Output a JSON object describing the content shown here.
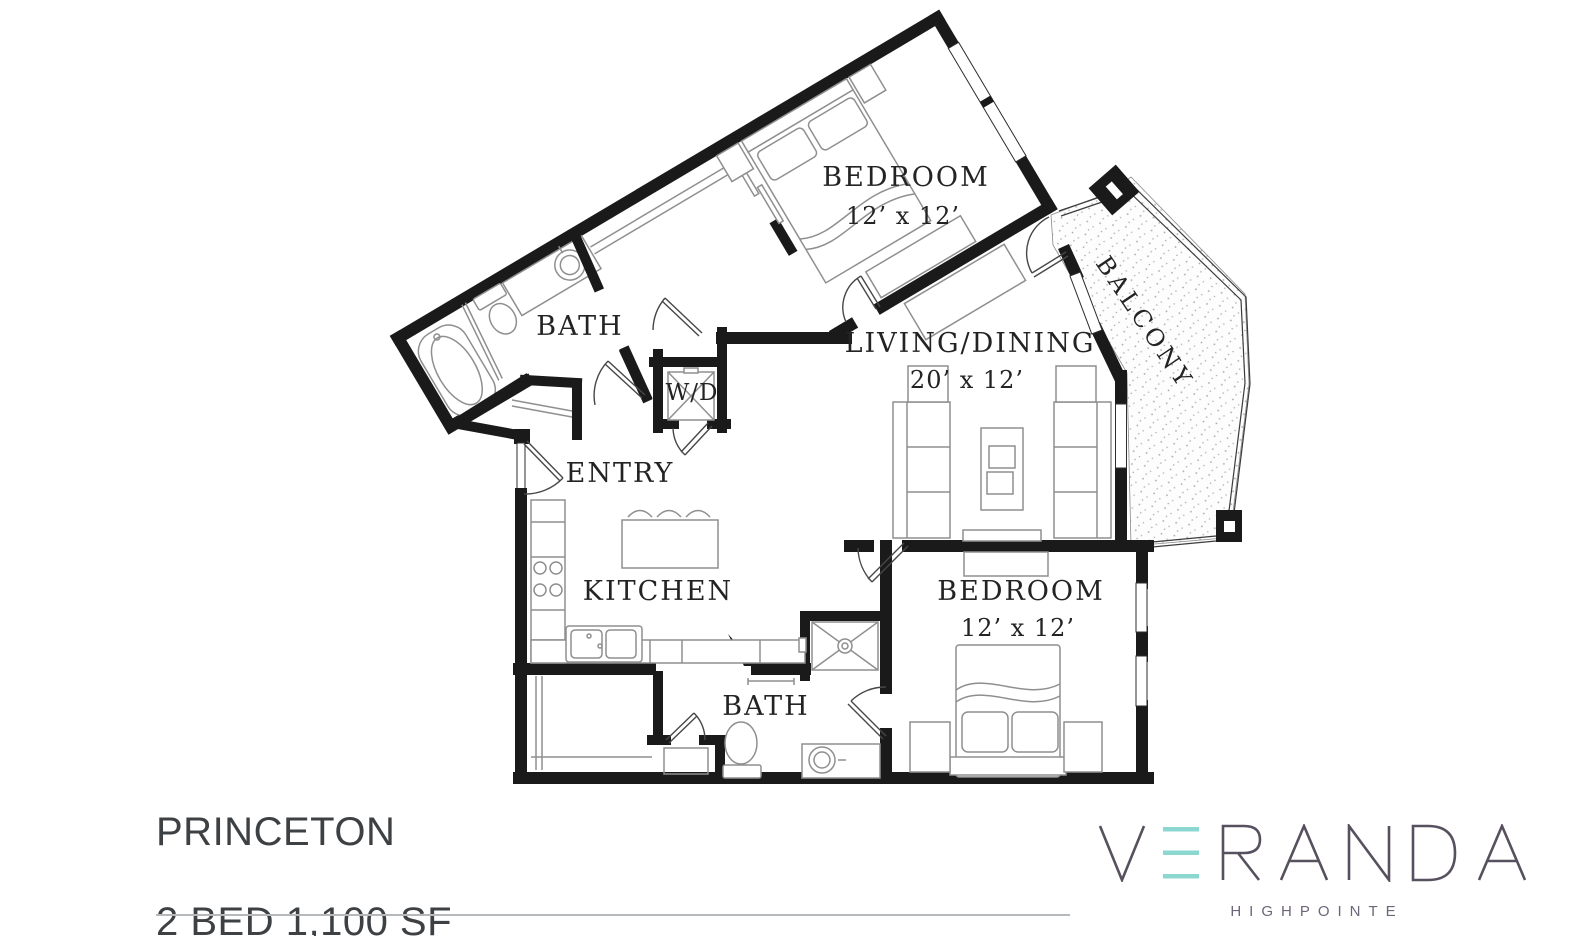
{
  "plan": {
    "rooms": {
      "bedroom1": {
        "label": "BEDROOM",
        "dims": "12’ x 12’"
      },
      "bath1": {
        "label": "BATH"
      },
      "wd": {
        "label": "W/D"
      },
      "living": {
        "label": "LIVING/DINING",
        "dims": "20’ x 12’"
      },
      "balcony": {
        "label": "BALCONY"
      },
      "entry": {
        "label": "ENTRY"
      },
      "kitchen": {
        "label": "KITCHEN"
      },
      "bedroom2": {
        "label": "BEDROOM",
        "dims": "12’ x 12’"
      },
      "bath2": {
        "label": "BATH"
      }
    }
  },
  "footer": {
    "plan_name": "PRINCETON",
    "plan_spec": "2 BED 1,100 SF"
  },
  "logo": {
    "brand": "VERANDA",
    "community": "HIGHPOINTE",
    "accent_color": "#8DD7D1",
    "letter_color": "#57505F"
  }
}
